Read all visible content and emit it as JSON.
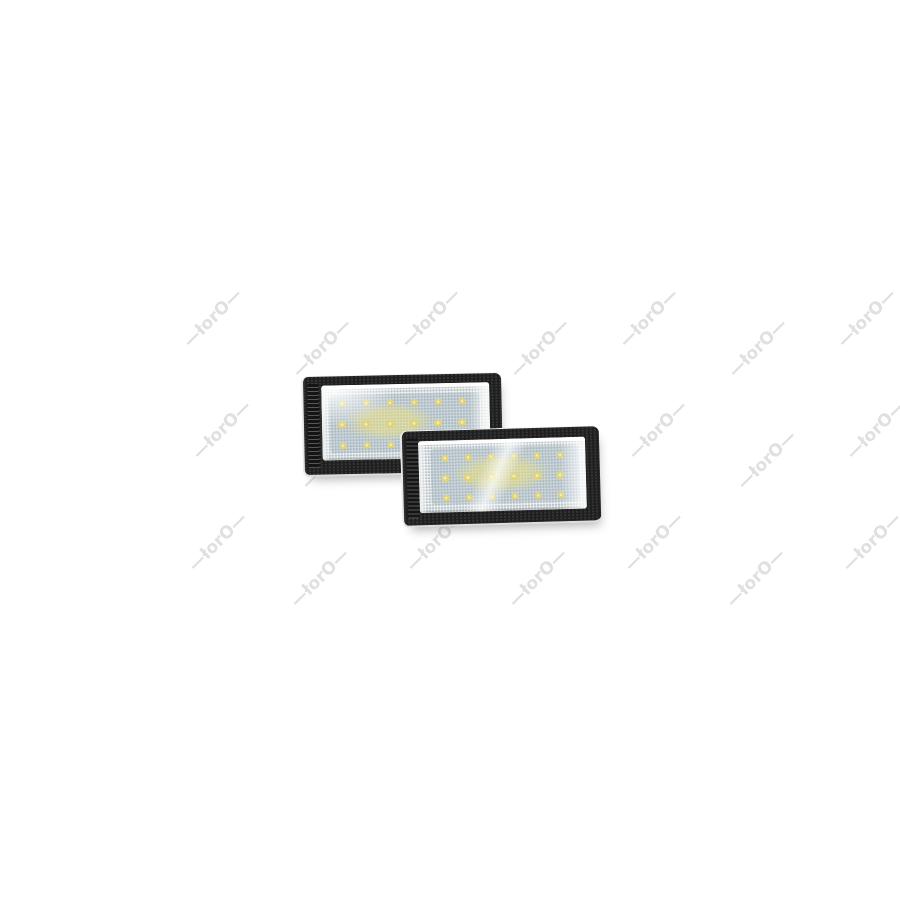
{
  "scene": {
    "type": "product-photo",
    "background": "#ffffff",
    "objects": "two black LED license plate lamp modules, overlapping, rear-left behind front-right"
  },
  "watermark": {
    "text": "—łorO—",
    "color": "#c7c7c7",
    "opacity": 0.55,
    "rotation_deg": -45,
    "font_size_px": 17,
    "positions": [
      {
        "x": 213,
        "y": 318
      },
      {
        "x": 431,
        "y": 318
      },
      {
        "x": 649,
        "y": 318
      },
      {
        "x": 867,
        "y": 318
      },
      {
        "x": 322,
        "y": 348
      },
      {
        "x": 540,
        "y": 348
      },
      {
        "x": 758,
        "y": 348
      },
      {
        "x": 222,
        "y": 430
      },
      {
        "x": 440,
        "y": 430
      },
      {
        "x": 658,
        "y": 430
      },
      {
        "x": 876,
        "y": 430
      },
      {
        "x": 331,
        "y": 460
      },
      {
        "x": 549,
        "y": 460
      },
      {
        "x": 767,
        "y": 460
      },
      {
        "x": 218,
        "y": 542
      },
      {
        "x": 436,
        "y": 542
      },
      {
        "x": 654,
        "y": 542
      },
      {
        "x": 872,
        "y": 542
      },
      {
        "x": 320,
        "y": 578
      },
      {
        "x": 538,
        "y": 578
      },
      {
        "x": 756,
        "y": 578
      }
    ]
  },
  "colors": {
    "frame": "#1f1f1f",
    "frame_speckle": "#4a4a4a",
    "edge_highlight": "#e8e8e8",
    "lens_base": "#f1f3f3",
    "lens_dot": "#b4bfc6",
    "led_zone_tint": "rgba(150,170,182,0.38)",
    "led_yellow": "#dfd37e",
    "led_bright": "#f3ecb0",
    "glow": "rgba(234,224,132,0.55)",
    "shadow": "rgba(95,95,95,0.45)"
  },
  "product": {
    "led_grid": {
      "rows": 3,
      "cols": 6,
      "size": 7,
      "middle_row_width": 10
    },
    "lamps": [
      {
        "id": "rear-lamp",
        "x": 302,
        "y": 374,
        "width": 198,
        "height": 98,
        "rotation_deg": -1.2,
        "z": 1,
        "lens": {
          "left": 18,
          "top": 9,
          "right": 12,
          "bottom": 14
        },
        "ridges": {
          "left": 4,
          "top": 7,
          "width": 12,
          "bottom": 7
        },
        "led_zone": {
          "x": 8,
          "y": 10,
          "w": 150,
          "h": 58
        },
        "led_origin": {
          "x": 20,
          "y": 18
        },
        "led_dx": 24,
        "led_dy": 21,
        "glow": {
          "x": 22,
          "y": 18,
          "w": 90,
          "h": 38
        },
        "reflections": {
          "right_width": 20,
          "streak": false,
          "top_left_bright": true
        }
      },
      {
        "id": "front-lamp",
        "x": 401,
        "y": 428,
        "width": 197,
        "height": 94,
        "rotation_deg": -1.6,
        "z": 2,
        "lens": {
          "left": 16,
          "top": 10,
          "right": 14,
          "bottom": 12
        },
        "ridges": {
          "left": 4,
          "top": 7,
          "width": 12,
          "bottom": 7
        },
        "led_zone": {
          "x": 12,
          "y": 8,
          "w": 148,
          "h": 56
        },
        "led_origin": {
          "x": 26,
          "y": 17
        },
        "led_dx": 23,
        "led_dy": 20,
        "glow": {
          "x": 34,
          "y": 14,
          "w": 96,
          "h": 40
        },
        "reflections": {
          "right_width": 26,
          "streak": true,
          "top_left_bright": false
        }
      }
    ]
  }
}
